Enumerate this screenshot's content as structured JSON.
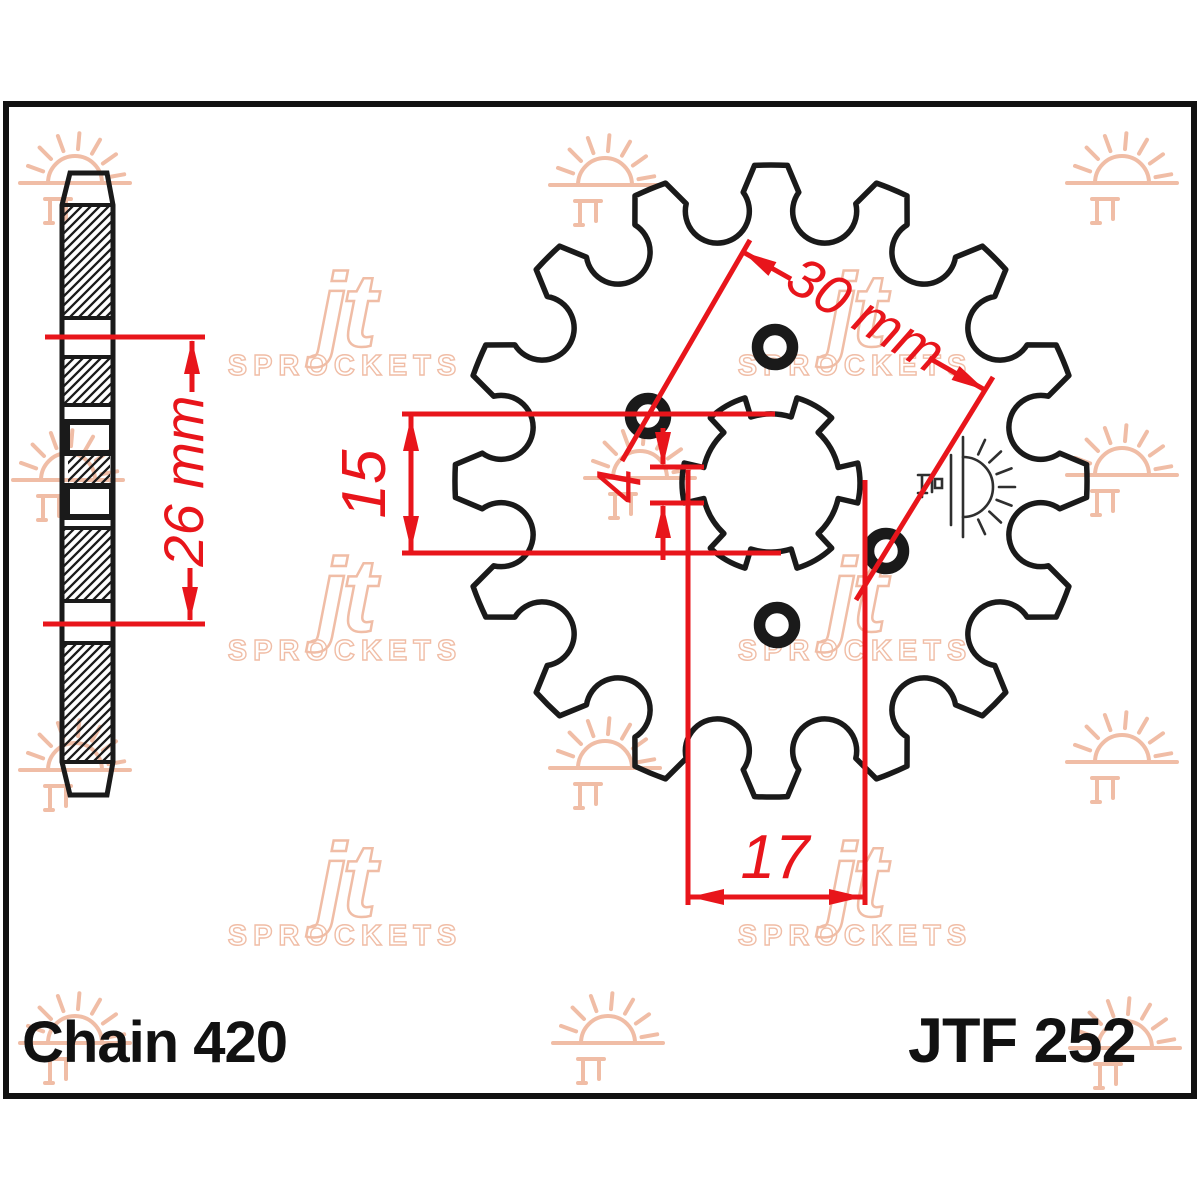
{
  "part": {
    "chain_label": "Chain 420",
    "part_number": "JTF 252"
  },
  "dimensions": {
    "overall_width": "26 mm",
    "bore_inner": "15",
    "spline_width": "4",
    "bolt_circle": "30 mm",
    "shaft_bore": "17"
  },
  "watermark": {
    "brand": "jt",
    "brand_sub": "SPROCKETS"
  },
  "sprocket": {
    "teeth": 16,
    "bolt_holes": 4,
    "spline_notches": 6
  },
  "colors": {
    "dimension": "#e8151b",
    "outline": "#1a1a1a",
    "watermark": "#f0bda6",
    "logo_mark": "#2f2f2f"
  }
}
